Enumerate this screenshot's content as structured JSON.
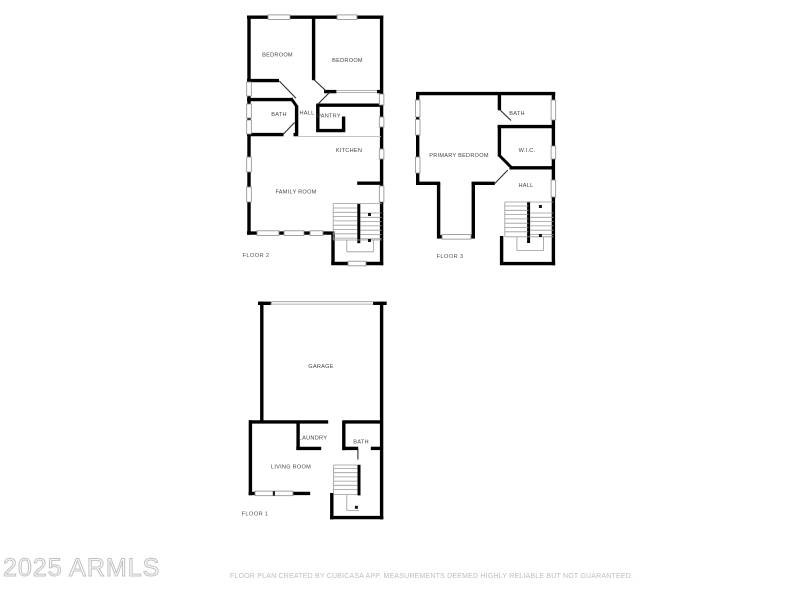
{
  "floors": {
    "floor2": {
      "label": "FLOOR 2",
      "rooms": {
        "bedroom1": "BEDROOM",
        "bedroom2": "BEDROOM",
        "bath": "BATH",
        "hall": "HALL",
        "pantry": "PANTRY",
        "kitchen": "KITCHEN",
        "family_room": "FAMILY ROOM"
      }
    },
    "floor3": {
      "label": "FLOOR 3",
      "rooms": {
        "primary_bedroom": "PRIMARY BEDROOM",
        "bath": "BATH",
        "wic": "W.I.C.",
        "hall": "HALL"
      }
    },
    "floor1": {
      "label": "FLOOR 1",
      "rooms": {
        "garage": "GARAGE",
        "laundry": "LAUNDRY",
        "bath": "BATH",
        "living_room": "LIVING ROOM"
      }
    }
  },
  "watermark": "2025 ARMLS",
  "disclaimer": "FLOOR PLAN CREATED BY CUBICASA APP. MEASUREMENTS DEEMED HIGHLY RELIABLE BUT NOT GUARANTEED.",
  "colors": {
    "wall": "#000000",
    "label": "#454545",
    "watermark": "#c1c1c1",
    "disclaimer": "#bdbdbd",
    "background": "#ffffff"
  }
}
